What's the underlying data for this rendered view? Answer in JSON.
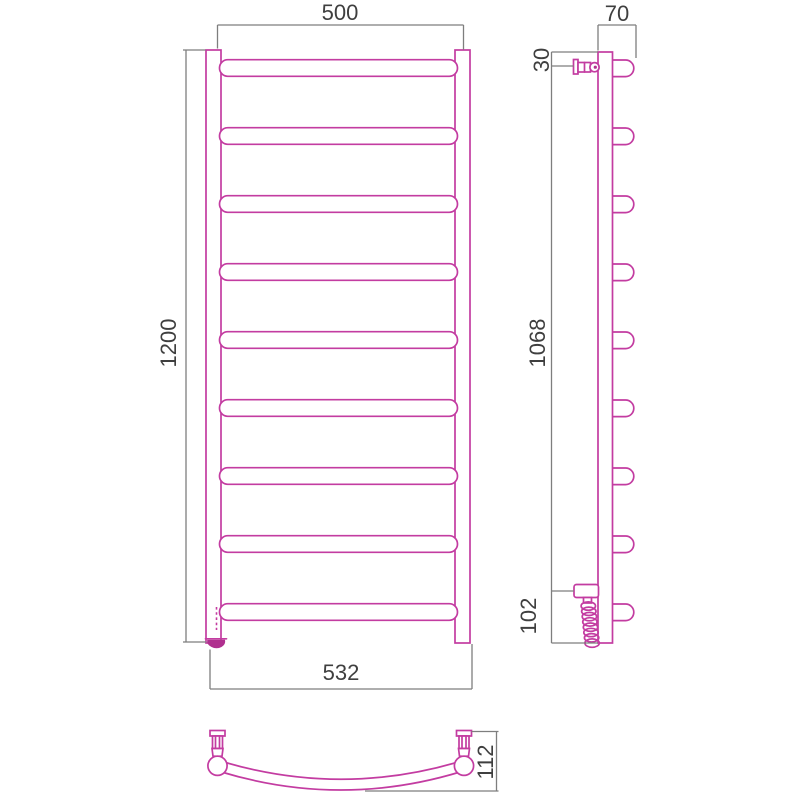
{
  "drawing": {
    "dimensions": {
      "front_top_width": "500",
      "front_height": "1200",
      "front_bottom_width": "532",
      "side_depth": "70",
      "side_top_offset": "30",
      "side_bracket_span": "1068",
      "side_bottom_offset": "102",
      "bottom_arc_depth": "112"
    },
    "views": {
      "front": {
        "rung_count": 9
      },
      "side": {
        "rung_count": 9,
        "coil_loops": 8
      },
      "bottom": {}
    },
    "colors": {
      "product_outline": "#c33ca1",
      "foot_fill": "#b0308f",
      "dimension_lines": "#7e7e7e",
      "label_text": "#3f3f3f"
    }
  }
}
